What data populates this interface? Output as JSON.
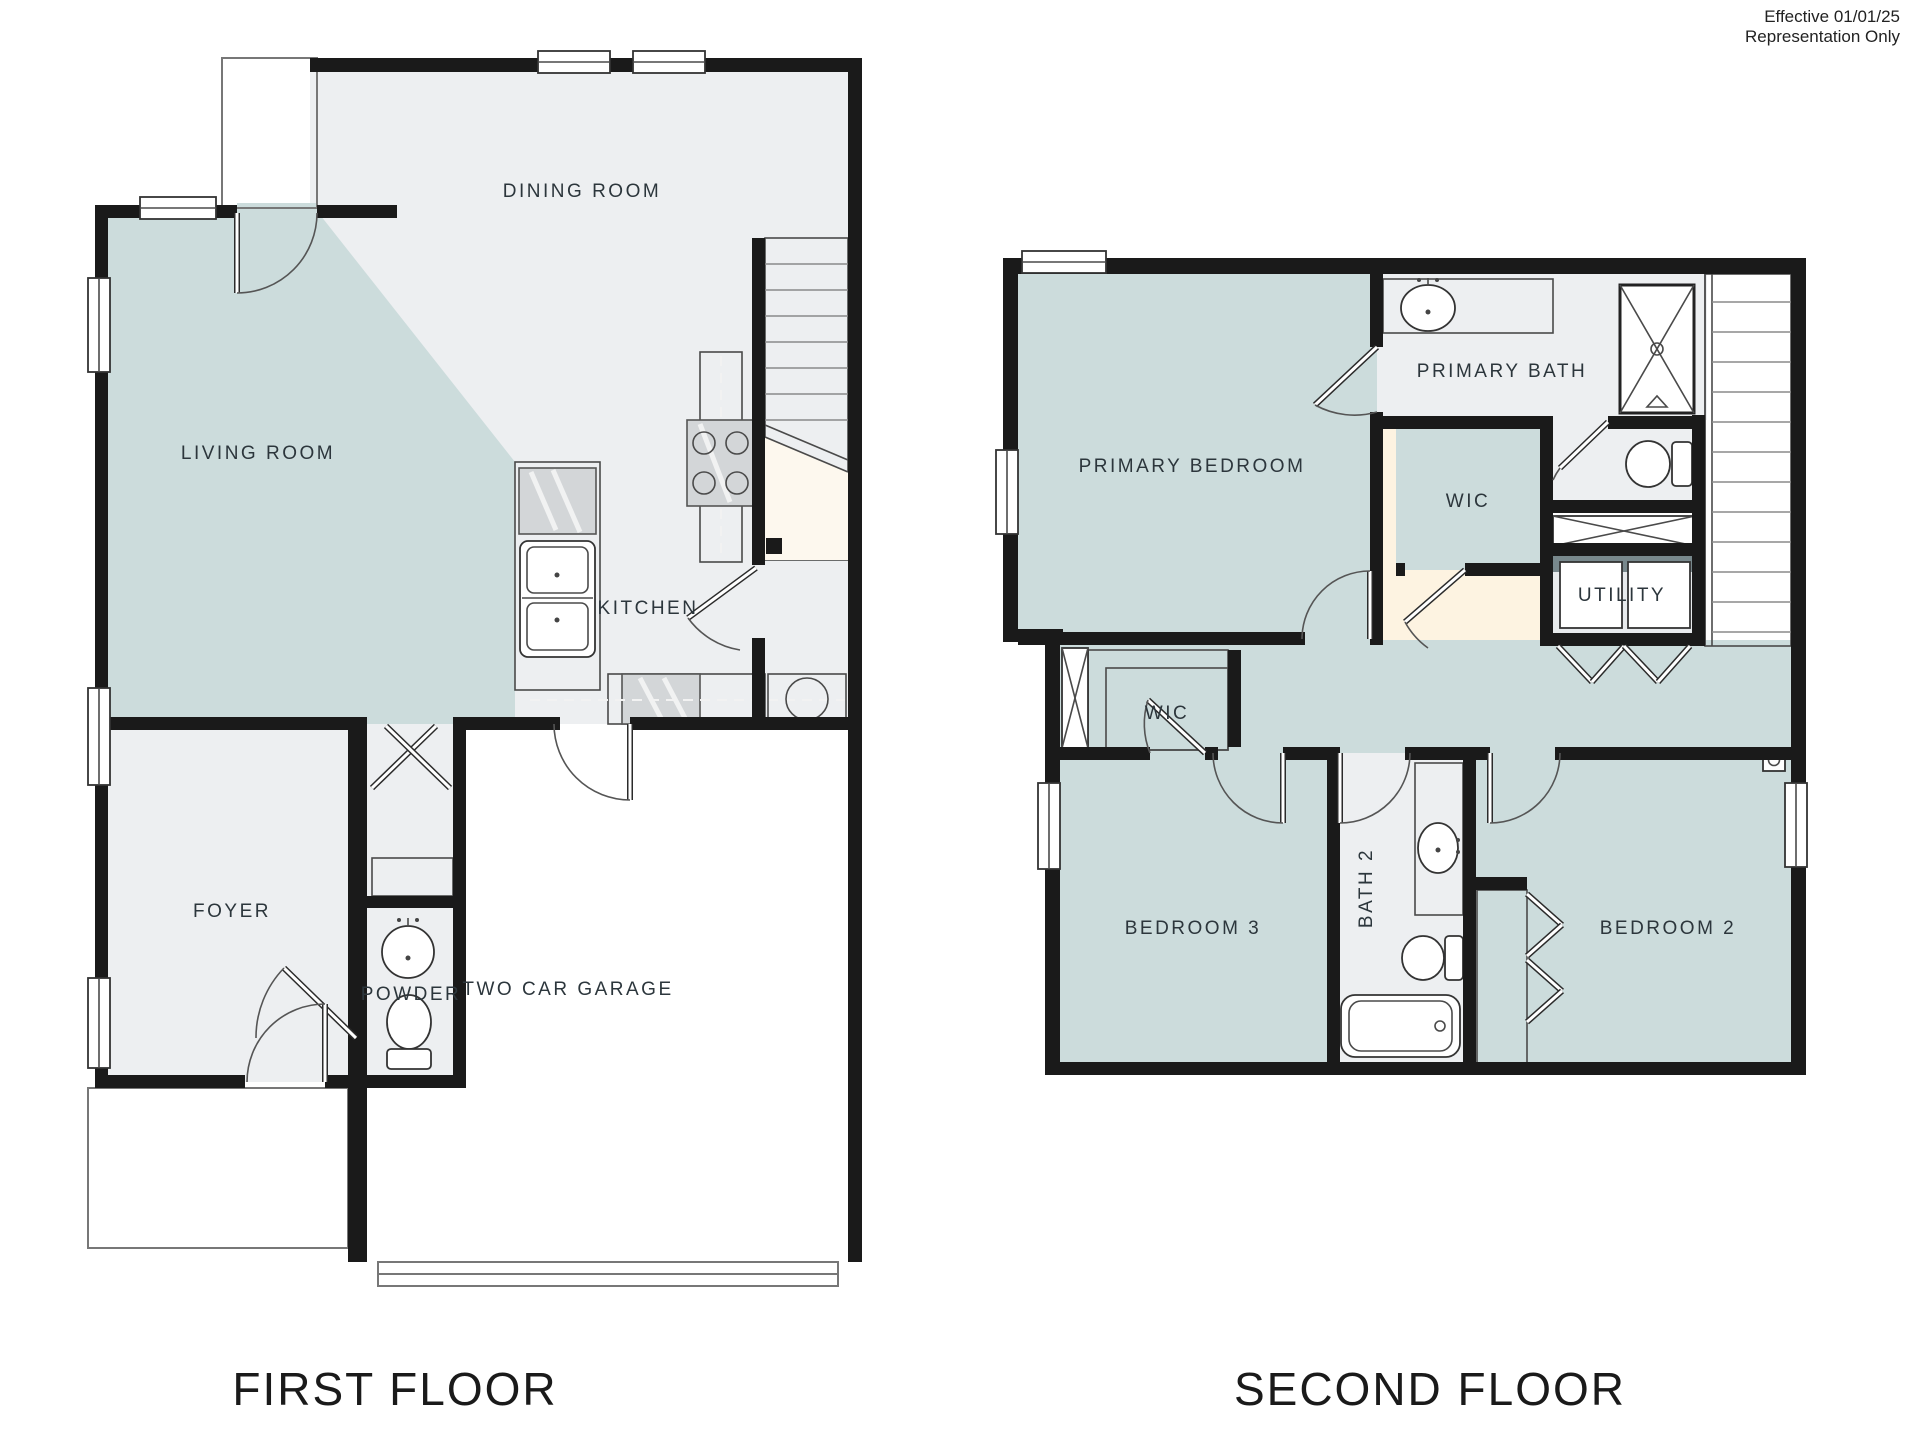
{
  "document": {
    "type": "floor-plan-sheet",
    "disclaimer": {
      "line1": "Effective 01/01/25",
      "line2": "Representation Only"
    }
  },
  "floors": {
    "first": {
      "title": "FIRST FLOOR",
      "rooms": {
        "dining_room": "DINING ROOM",
        "living_room": "LIVING ROOM",
        "kitchen": "KITCHEN",
        "foyer": "FOYER",
        "powder": "POWDER",
        "garage": "TWO CAR GARAGE"
      },
      "fixtures": [
        "kitchen-island-sink",
        "dishwasher",
        "range-cooktop",
        "counter",
        "stairs",
        "powder-sink",
        "powder-toilet",
        "coat-closet-shelf",
        "garage-door",
        "porch-slab",
        "entry-door"
      ]
    },
    "second": {
      "title": "SECOND FLOOR",
      "rooms": {
        "primary_bedroom": "PRIMARY BEDROOM",
        "primary_bath": "PRIMARY BATH",
        "wic_primary": "WIC",
        "wic_hall": "WIC",
        "utility": "UTILITY",
        "bedroom_3": "BEDROOM 3",
        "bath_2": "BATH 2",
        "bedroom_2": "BEDROOM 2"
      },
      "fixtures": [
        "vanity-sink",
        "shower",
        "toilet",
        "linen-closet",
        "washer",
        "dryer",
        "stairs",
        "bathtub",
        "bath2-vanity-sink",
        "bath2-toilet",
        "closet-bifold-doors",
        "linen-closet-hall"
      ]
    }
  },
  "colors": {
    "wall": "#1a1a1a",
    "room_teal": "#ccdcdc",
    "room_gray": "#edeff1",
    "stairs_cream": "#fdf3e1",
    "counter_gray": "#78888c",
    "fixture_white": "#ffffff"
  }
}
